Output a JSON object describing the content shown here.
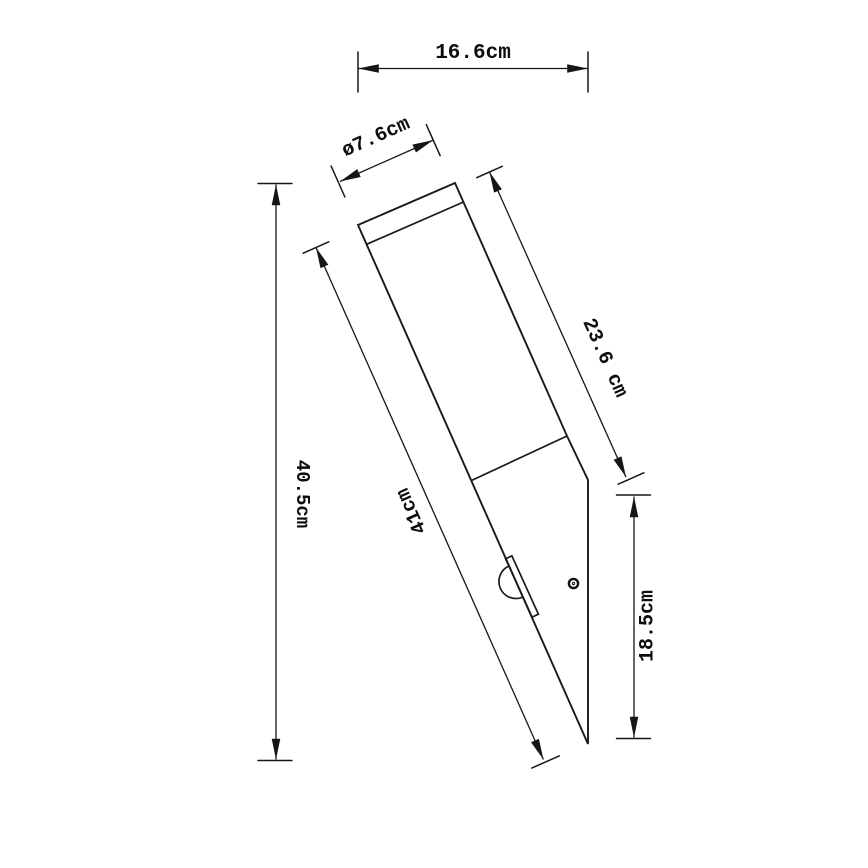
{
  "drawing": {
    "unit": "cm",
    "dimensions": {
      "overall_width": {
        "label": "16.6cm",
        "value_cm": 16.6
      },
      "diameter": {
        "label": "ø7.6cm",
        "value_cm": 7.6
      },
      "tube_length": {
        "label": "23.6 cm",
        "value_cm": 23.6
      },
      "total_length": {
        "label": "41cm",
        "value_cm": 41
      },
      "overall_height": {
        "label": "40.5cm",
        "value_cm": 40.5
      },
      "back_height": {
        "label": "18.5cm",
        "value_cm": 18.5
      }
    }
  }
}
